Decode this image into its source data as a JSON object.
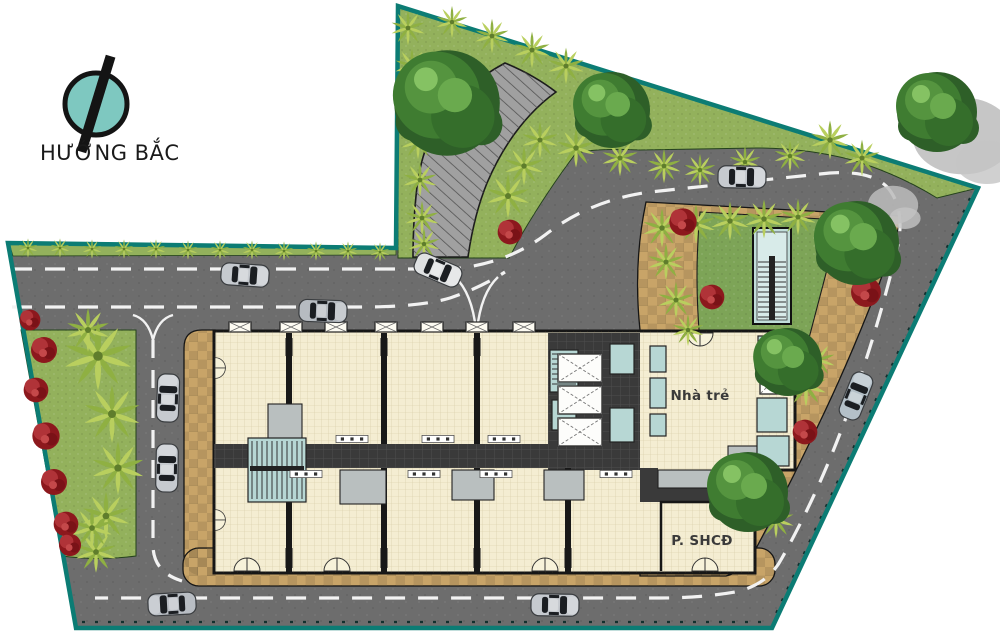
{
  "north": {
    "label": "HƯỚNG BẮC"
  },
  "plan": {
    "rooms": [
      {
        "label": "Nhà trẻ"
      },
      {
        "label": "P. SHCĐ"
      }
    ]
  },
  "palette": {
    "boundary": "#0c7c74",
    "road": "#6d6d6d",
    "plaza": "#a0a0a0",
    "grass": "#93b15c",
    "lawn": "#7da457",
    "paving": "#c8a468",
    "building": "#f4edd2",
    "corridor": "#3a3a3a",
    "room_teal": "#b7d7d4",
    "shrub_red": "#8c181d",
    "road_marking": "#f2f2f2",
    "logo_teal": "#7ec8c0"
  },
  "scene": {
    "shadows": [
      {
        "x": 963,
        "y": 136,
        "s": 1.2
      },
      {
        "x": 893,
        "y": 205,
        "s": 0.6
      }
    ],
    "palms": [
      {
        "x": 98,
        "y": 356,
        "s": 1.5
      },
      {
        "x": 112,
        "y": 414,
        "s": 1.25
      },
      {
        "x": 118,
        "y": 468,
        "s": 1.15
      },
      {
        "x": 106,
        "y": 516,
        "s": 1.05
      },
      {
        "x": 88,
        "y": 330,
        "s": 0.95
      },
      {
        "x": 96,
        "y": 552,
        "s": 0.9
      },
      {
        "x": 92,
        "y": 528,
        "s": 0.9
      },
      {
        "x": 28,
        "y": 248,
        "s": 0.42
      },
      {
        "x": 60,
        "y": 248,
        "s": 0.42
      },
      {
        "x": 92,
        "y": 249,
        "s": 0.42
      },
      {
        "x": 124,
        "y": 249,
        "s": 0.42
      },
      {
        "x": 156,
        "y": 249,
        "s": 0.42
      },
      {
        "x": 188,
        "y": 250,
        "s": 0.42
      },
      {
        "x": 220,
        "y": 250,
        "s": 0.42
      },
      {
        "x": 252,
        "y": 250,
        "s": 0.42
      },
      {
        "x": 284,
        "y": 251,
        "s": 0.42
      },
      {
        "x": 316,
        "y": 251,
        "s": 0.42
      },
      {
        "x": 348,
        "y": 251,
        "s": 0.42
      },
      {
        "x": 380,
        "y": 252,
        "s": 0.42
      },
      {
        "x": 408,
        "y": 28,
        "s": 0.75
      },
      {
        "x": 412,
        "y": 66,
        "s": 0.75
      },
      {
        "x": 415,
        "y": 104,
        "s": 0.75
      },
      {
        "x": 418,
        "y": 142,
        "s": 0.75
      },
      {
        "x": 420,
        "y": 180,
        "s": 0.75
      },
      {
        "x": 422,
        "y": 218,
        "s": 0.75
      },
      {
        "x": 424,
        "y": 244,
        "s": 0.7
      },
      {
        "x": 452,
        "y": 22,
        "s": 0.7
      },
      {
        "x": 492,
        "y": 36,
        "s": 0.75
      },
      {
        "x": 532,
        "y": 50,
        "s": 0.8
      },
      {
        "x": 566,
        "y": 66,
        "s": 0.8
      },
      {
        "x": 576,
        "y": 148,
        "s": 0.85
      },
      {
        "x": 620,
        "y": 158,
        "s": 0.8
      },
      {
        "x": 664,
        "y": 166,
        "s": 0.75
      },
      {
        "x": 700,
        "y": 170,
        "s": 0.7
      },
      {
        "x": 745,
        "y": 162,
        "s": 0.7
      },
      {
        "x": 790,
        "y": 156,
        "s": 0.7
      },
      {
        "x": 830,
        "y": 140,
        "s": 0.85
      },
      {
        "x": 862,
        "y": 158,
        "s": 0.8
      },
      {
        "x": 508,
        "y": 196,
        "s": 0.95
      },
      {
        "x": 524,
        "y": 166,
        "s": 0.85
      },
      {
        "x": 540,
        "y": 140,
        "s": 0.8
      },
      {
        "x": 662,
        "y": 228,
        "s": 0.85
      },
      {
        "x": 696,
        "y": 224,
        "s": 0.85
      },
      {
        "x": 730,
        "y": 221,
        "s": 0.85
      },
      {
        "x": 764,
        "y": 219,
        "s": 0.85
      },
      {
        "x": 798,
        "y": 217,
        "s": 0.8
      },
      {
        "x": 666,
        "y": 262,
        "s": 0.8
      },
      {
        "x": 676,
        "y": 300,
        "s": 0.8
      },
      {
        "x": 688,
        "y": 330,
        "s": 0.7
      },
      {
        "x": 806,
        "y": 386,
        "s": 0.9
      },
      {
        "x": 818,
        "y": 360,
        "s": 0.75
      },
      {
        "x": 776,
        "y": 520,
        "s": 0.8
      }
    ],
    "shrubs": [
      {
        "x": 44,
        "y": 350,
        "s": 1.0
      },
      {
        "x": 36,
        "y": 390,
        "s": 0.95
      },
      {
        "x": 46,
        "y": 436,
        "s": 1.05
      },
      {
        "x": 54,
        "y": 482,
        "s": 1.0
      },
      {
        "x": 66,
        "y": 524,
        "s": 0.95
      },
      {
        "x": 30,
        "y": 320,
        "s": 0.8
      },
      {
        "x": 70,
        "y": 545,
        "s": 0.85
      },
      {
        "x": 414,
        "y": 130,
        "s": 0.85
      },
      {
        "x": 510,
        "y": 232,
        "s": 0.95
      },
      {
        "x": 683,
        "y": 222,
        "s": 1.05
      },
      {
        "x": 712,
        "y": 297,
        "s": 0.95
      },
      {
        "x": 866,
        "y": 292,
        "s": 1.15
      },
      {
        "x": 805,
        "y": 432,
        "s": 0.95
      },
      {
        "x": 768,
        "y": 508,
        "s": 0.85
      }
    ],
    "trees": [
      {
        "x": 447,
        "y": 103,
        "s": 1.32
      },
      {
        "x": 612,
        "y": 110,
        "s": 0.95
      },
      {
        "x": 937,
        "y": 112,
        "s": 1.0
      },
      {
        "x": 857,
        "y": 243,
        "s": 1.05
      },
      {
        "x": 788,
        "y": 362,
        "s": 0.85
      },
      {
        "x": 748,
        "y": 492,
        "s": 1.0
      }
    ],
    "cars": [
      {
        "x": 245,
        "y": 275,
        "rot": 184,
        "color": "#c6cacf"
      },
      {
        "x": 323,
        "y": 311,
        "rot": 182,
        "color": "#b6bbc1"
      },
      {
        "x": 438,
        "y": 270,
        "rot": 203,
        "color": "#dfe1e2"
      },
      {
        "x": 742,
        "y": 177,
        "rot": 181,
        "color": "#c6cacf"
      },
      {
        "x": 856,
        "y": 396,
        "rot": 112,
        "color": "#b4c0c8"
      },
      {
        "x": 168,
        "y": 398,
        "rot": 92,
        "color": "#c6cacf"
      },
      {
        "x": 167,
        "y": 468,
        "rot": 91,
        "color": "#c6cacf"
      },
      {
        "x": 172,
        "y": 604,
        "rot": -3,
        "color": "#b9bec4"
      },
      {
        "x": 555,
        "y": 605,
        "rot": 181,
        "color": "#c6cacf"
      }
    ]
  }
}
